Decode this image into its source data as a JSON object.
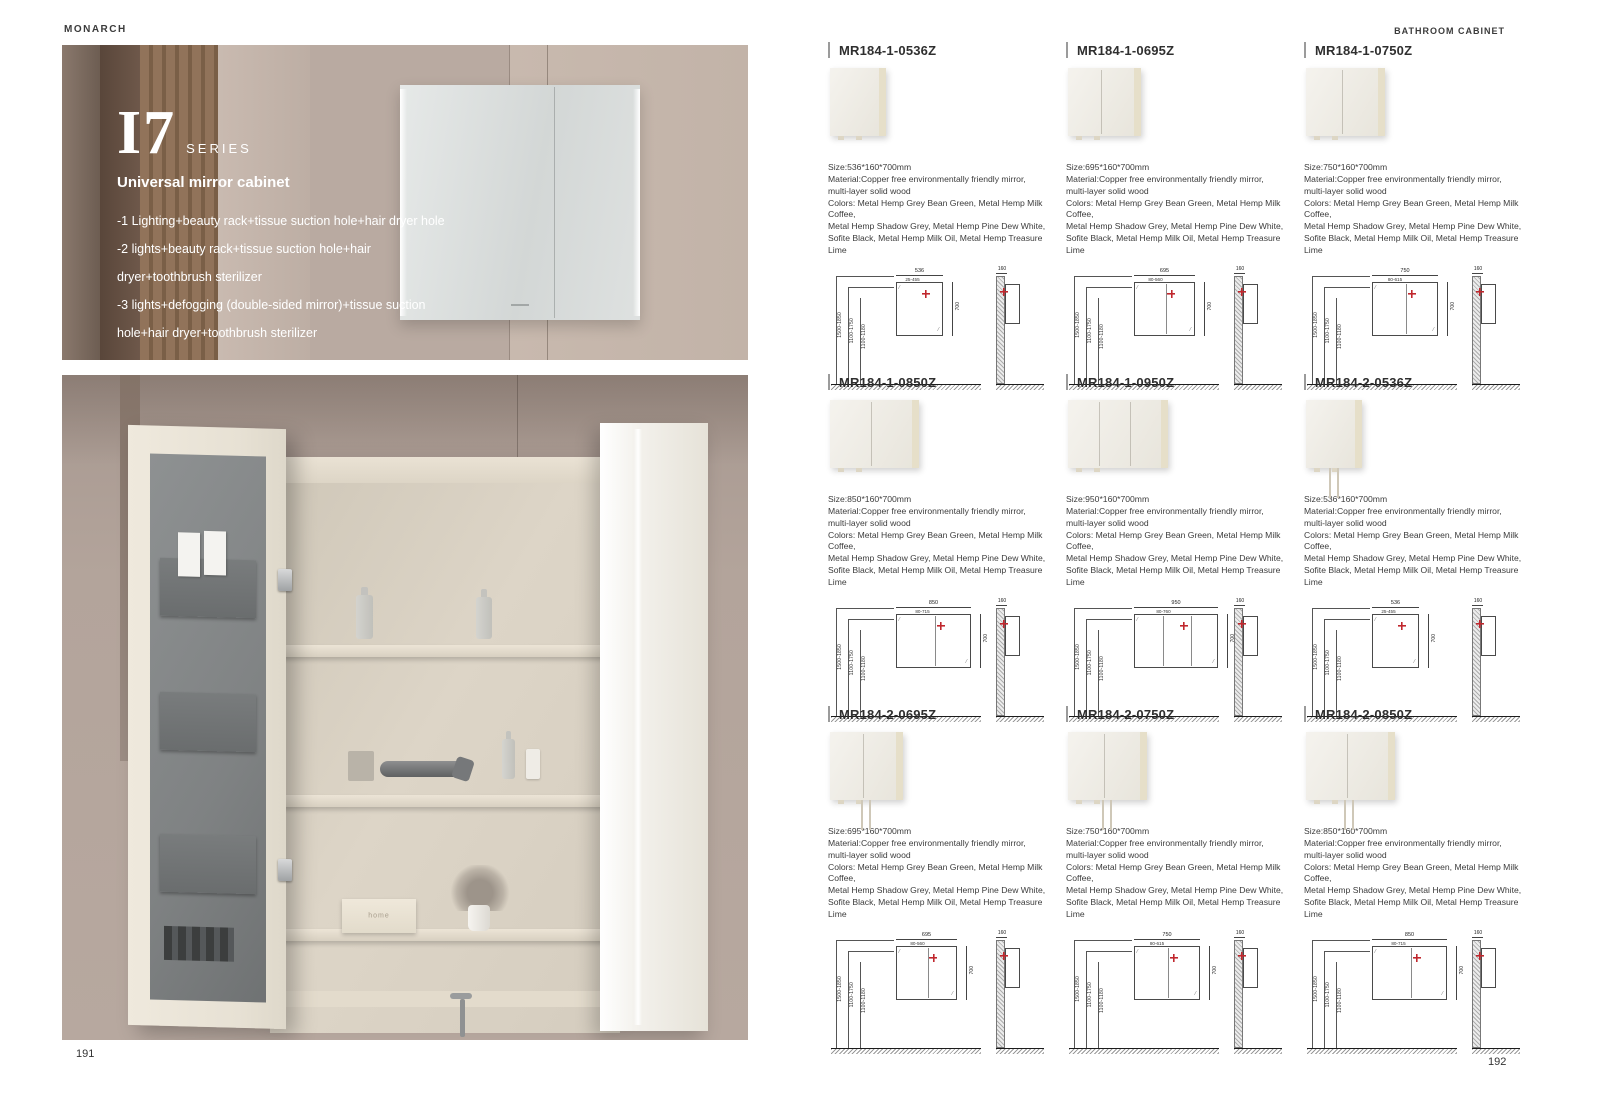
{
  "header": {
    "brand": "MONARCH",
    "category": "BATHROOM CABINET"
  },
  "left_page": {
    "page_number": "191",
    "series": "I7",
    "series_suffix": "SERIES",
    "subtitle": "Universal mirror cabinet",
    "features": [
      "-1 Lighting+beauty rack+tissue suction hole+hair dryer hole",
      "-2 lights+beauty rack+tissue suction hole+hair dryer+toothbrush sterilizer",
      "-3 lights+defogging (double-sided mirror)+tissue suction hole+hair dryer+toothbrush sterilizer"
    ],
    "home_box_label": "home"
  },
  "right_page": {
    "page_number": "192",
    "shared": {
      "material_line1": "Material:Copper free environmentally friendly mirror,",
      "material_line2": "multi-layer solid wood",
      "colors_line1": "Colors: Metal Hemp Grey Bean Green, Metal Hemp Milk Coffee,",
      "colors_line2": "Metal Hemp Shadow Grey, Metal Hemp Pine Dew White,",
      "colors_line3": "Sofite Black, Metal Hemp Milk Oil, Metal Hemp Treasure Lime",
      "diagram": {
        "mount_heights": [
          "1500-1850",
          "1100-1750",
          "1100-1180"
        ],
        "cabinet_height": "700",
        "cabinet_depth": "160",
        "accent_color": "#c0272d"
      }
    },
    "products": [
      {
        "code": "MR184-1-0536Z",
        "size": "Size:536*160*700mm",
        "width_label": "536",
        "width_range": "25-455",
        "splits": 0,
        "cords": false
      },
      {
        "code": "MR184-1-0695Z",
        "size": "Size:695*160*700mm",
        "width_label": "695",
        "width_range": "80-560",
        "splits": 1,
        "cords": false
      },
      {
        "code": "MR184-1-0750Z",
        "size": "Size:750*160*700mm",
        "width_label": "750",
        "width_range": "80-615",
        "splits": 1,
        "cords": false
      },
      {
        "code": "MR184-1-0850Z",
        "size": "Size:850*160*700mm",
        "width_label": "850",
        "width_range": "80-715",
        "splits": 1,
        "cords": false
      },
      {
        "code": "MR184-1-0950Z",
        "size": "Size:950*160*700mm",
        "width_label": "950",
        "width_range": "80-760",
        "splits": 2,
        "cords": false
      },
      {
        "code": "MR184-2-0536Z",
        "size": "Size:536*160*700mm",
        "width_label": "536",
        "width_range": "25-455",
        "splits": 0,
        "cords": true
      },
      {
        "code": "MR184-2-0695Z",
        "size": "Size:695*160*700mm",
        "width_label": "695",
        "width_range": "80-560",
        "splits": 1,
        "cords": true
      },
      {
        "code": "MR184-2-0750Z",
        "size": "Size:750*160*700mm",
        "width_label": "750",
        "width_range": "80-615",
        "splits": 1,
        "cords": true
      },
      {
        "code": "MR184-2-0850Z",
        "size": "Size:850*160*700mm",
        "width_label": "850",
        "width_range": "80-715",
        "splits": 1,
        "cords": true
      }
    ]
  }
}
